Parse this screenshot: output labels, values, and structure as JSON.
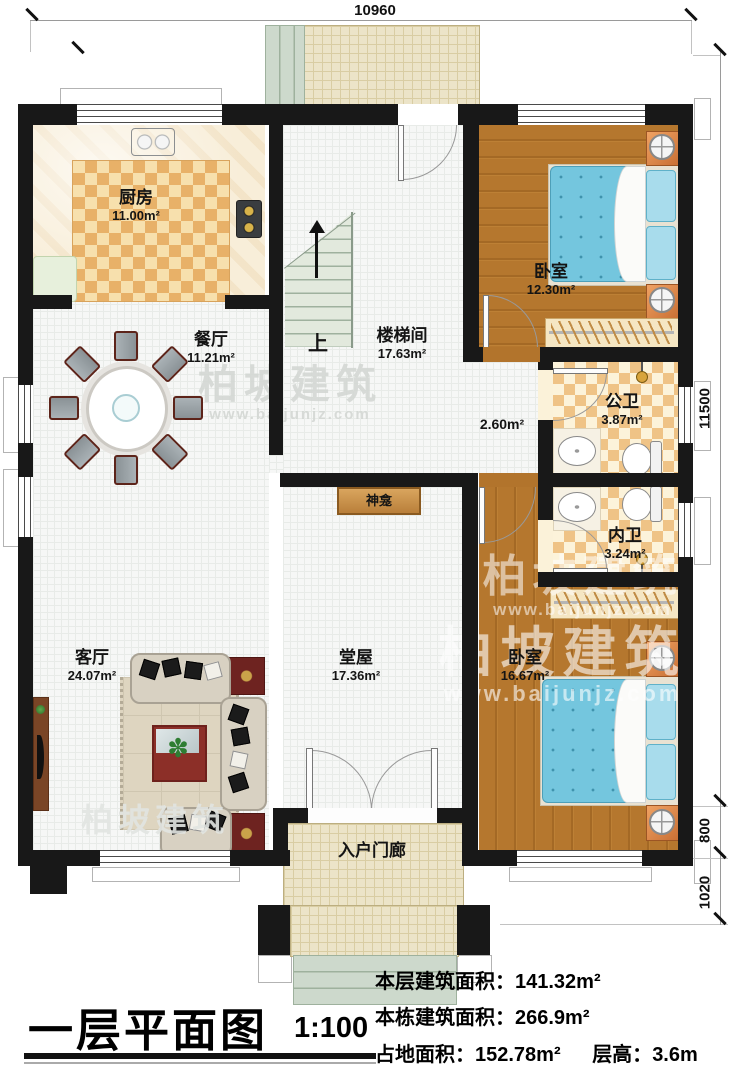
{
  "watermark": {
    "brand": "柏坡建筑",
    "url": "www.baijunjz.com"
  },
  "dimensions": {
    "top": "10960",
    "right_total": "11500",
    "right_seg1": "800",
    "right_seg2": "1020"
  },
  "rooms": {
    "kitchen": {
      "name": "厨房",
      "area": "11.00m²"
    },
    "dining": {
      "name": "餐厅",
      "area": "11.21m²"
    },
    "stairwell": {
      "name": "楼梯间",
      "area": "17.63m²"
    },
    "corridor": {
      "area": "2.60m²"
    },
    "bedroom_top": {
      "name": "卧室",
      "area": "12.30m²"
    },
    "public_bath": {
      "name": "公卫",
      "area": "3.87m²"
    },
    "private_bath": {
      "name": "内卫",
      "area": "3.24m²"
    },
    "bedroom_bottom": {
      "name": "卧室",
      "area": "16.67m²"
    },
    "living": {
      "name": "客厅",
      "area": "24.07m²"
    },
    "hall": {
      "name": "堂屋",
      "area": "17.36m²"
    },
    "porch": {
      "name": "入户门廊"
    }
  },
  "annotations": {
    "stairs_up": "上",
    "shrine": "神龛"
  },
  "title": {
    "text": "一层平面图",
    "scale": "1:100"
  },
  "stats": {
    "line1_label": "本层建筑面积：",
    "line1_value": "141.32m²",
    "line2_label": "本栋建筑面积：",
    "line2_value": "266.9m²",
    "line3_label": "占地面积：",
    "line3_value": "152.78m²",
    "line3b_label": "层高：",
    "line3b_value": "3.6m"
  }
}
